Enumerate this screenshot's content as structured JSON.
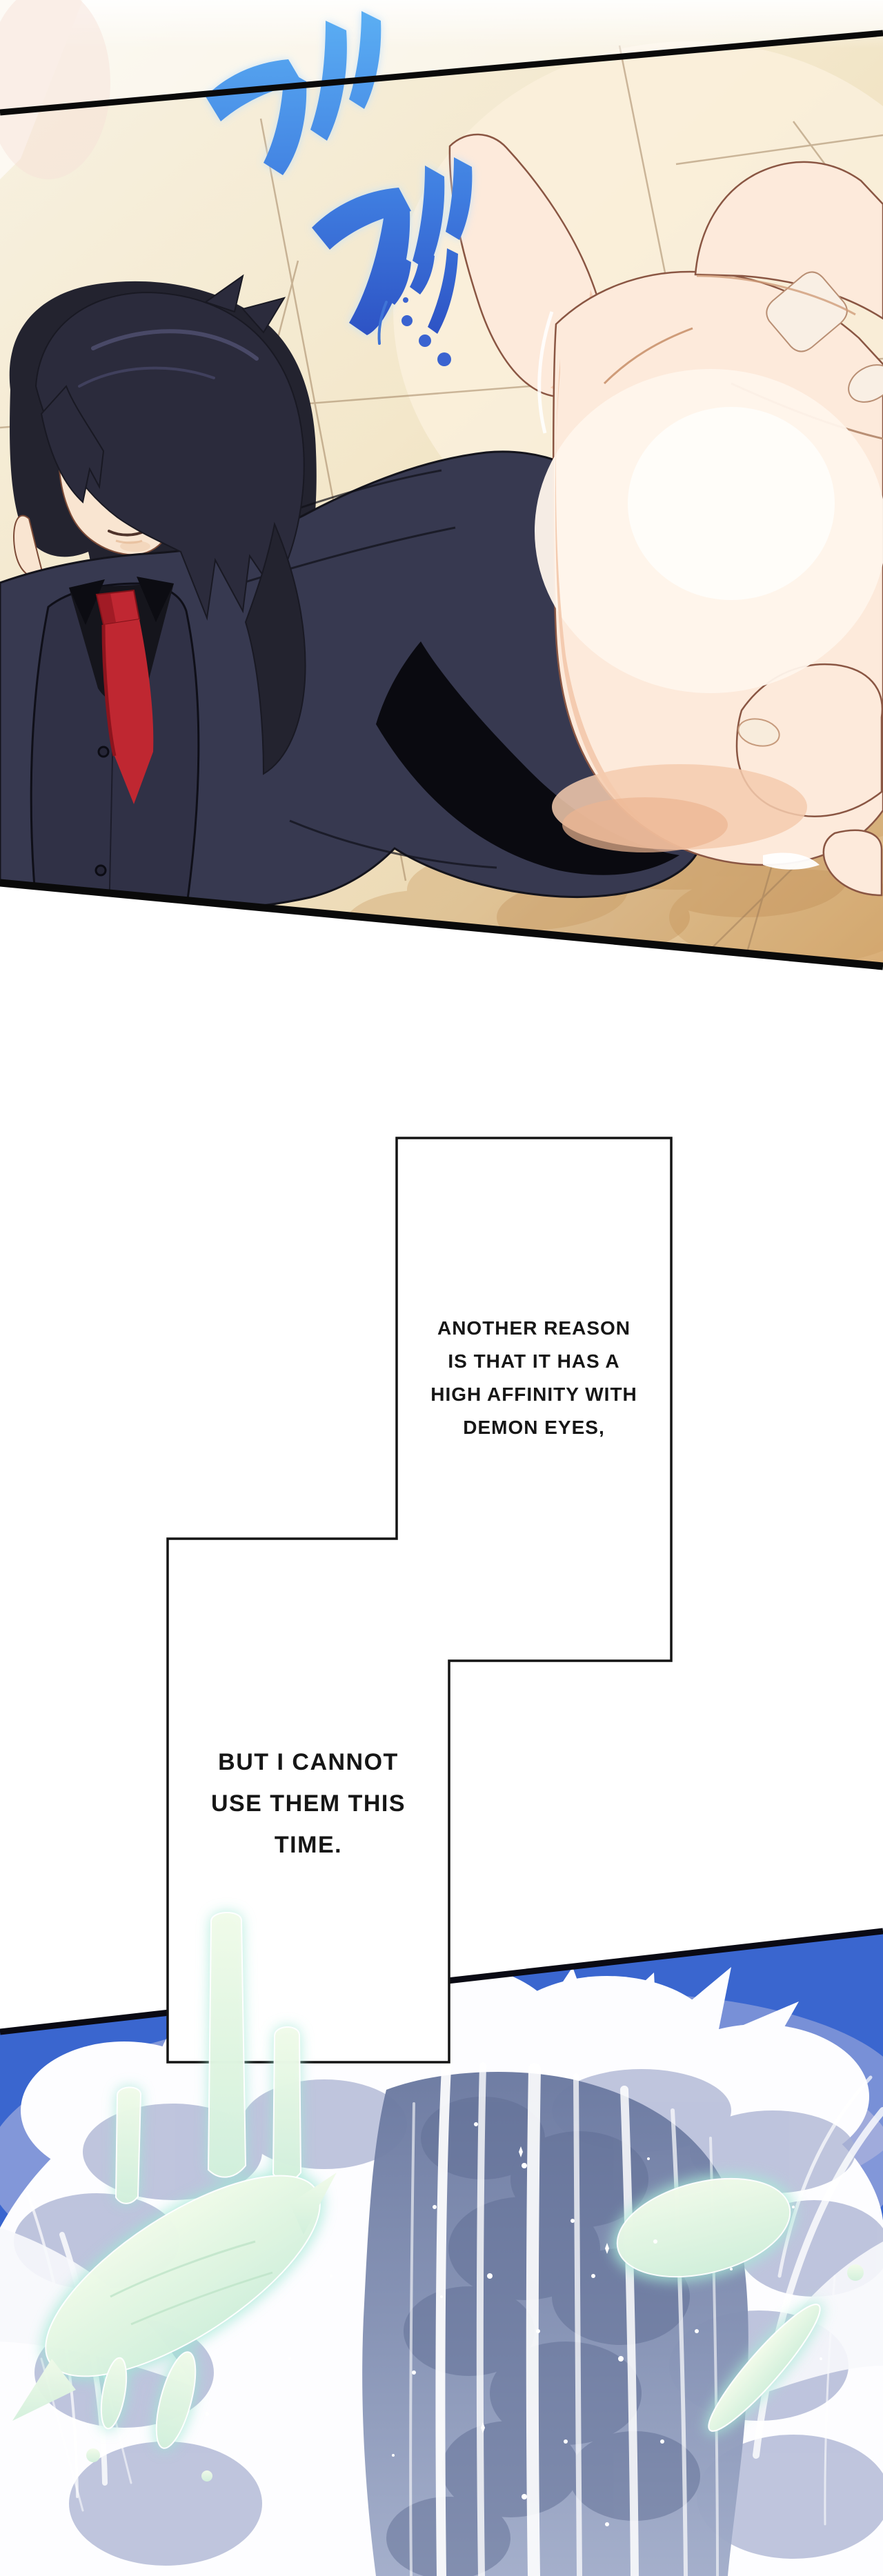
{
  "comic": {
    "narration_box_1": {
      "lines": [
        "ANOTHER REASON",
        "IS THAT IT HAS A",
        "HIGH AFFINITY WITH",
        "DEMON EYES,"
      ]
    },
    "narration_box_2": {
      "lines": [
        "BUT I CANNOT",
        "USE THEM THIS",
        "TIME."
      ]
    },
    "sfx": {
      "script": "ガガ",
      "reading": "ga ga (grab impact)"
    },
    "colors": {
      "page_background": "#ffffff",
      "panel_border": "#0b0b0b",
      "tile_light": "#f8f2e3",
      "tile_dark": "#d9ae77",
      "sfx_blue_top": "#5cb0f4",
      "sfx_blue_bottom": "#2743ba",
      "suit": "#373950",
      "necktie_red": "#bf2731",
      "eye_teal": "#2e8e7c",
      "splash_blue": "#3a66cf",
      "foam_shadow": "#9ca8cd",
      "ice_shard_mint": "#e4f6e0"
    }
  }
}
